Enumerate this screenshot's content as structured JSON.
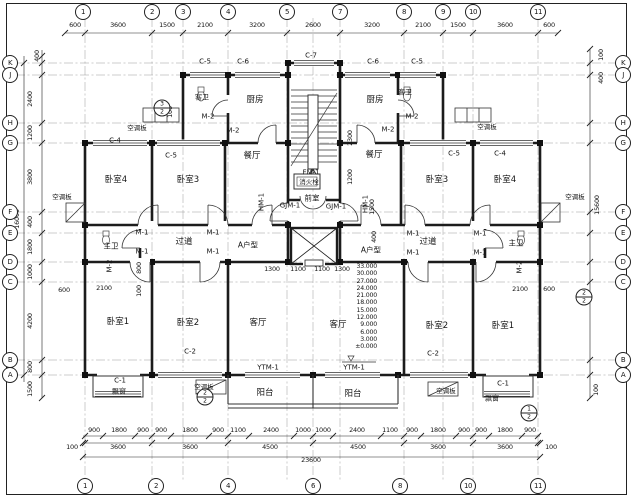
{
  "drawing": {
    "type": "architectural-floor-plan",
    "unit_type_label": "A户型",
    "background_color": "#ffffff",
    "line_color": "#1c1c1c",
    "grid_bubbles": [
      {
        "n": "1",
        "x": 83,
        "y": 12
      },
      {
        "n": "2",
        "x": 152,
        "y": 12
      },
      {
        "n": "3",
        "x": 183,
        "y": 12
      },
      {
        "n": "4",
        "x": 228,
        "y": 12
      },
      {
        "n": "5",
        "x": 287,
        "y": 12
      },
      {
        "n": "7",
        "x": 340,
        "y": 12
      },
      {
        "n": "8",
        "x": 404,
        "y": 12
      },
      {
        "n": "9",
        "x": 443,
        "y": 12
      },
      {
        "n": "10",
        "x": 473,
        "y": 12
      },
      {
        "n": "11",
        "x": 538,
        "y": 12
      },
      {
        "n": "1",
        "x": 85,
        "y": 486
      },
      {
        "n": "2",
        "x": 156,
        "y": 486
      },
      {
        "n": "4",
        "x": 228,
        "y": 486
      },
      {
        "n": "6",
        "x": 313,
        "y": 486
      },
      {
        "n": "8",
        "x": 400,
        "y": 486
      },
      {
        "n": "10",
        "x": 468,
        "y": 486
      },
      {
        "n": "11",
        "x": 538,
        "y": 486
      },
      {
        "n": "K",
        "x": 10,
        "y": 63
      },
      {
        "n": "J",
        "x": 10,
        "y": 75
      },
      {
        "n": "H",
        "x": 10,
        "y": 123
      },
      {
        "n": "G",
        "x": 10,
        "y": 143
      },
      {
        "n": "F",
        "x": 10,
        "y": 212
      },
      {
        "n": "E",
        "x": 10,
        "y": 233
      },
      {
        "n": "D",
        "x": 10,
        "y": 262
      },
      {
        "n": "C",
        "x": 10,
        "y": 282
      },
      {
        "n": "B",
        "x": 10,
        "y": 360
      },
      {
        "n": "A",
        "x": 10,
        "y": 375
      },
      {
        "n": "K",
        "x": 623,
        "y": 63
      },
      {
        "n": "J",
        "x": 623,
        "y": 75
      },
      {
        "n": "H",
        "x": 623,
        "y": 123
      },
      {
        "n": "G",
        "x": 623,
        "y": 143
      },
      {
        "n": "F",
        "x": 623,
        "y": 212
      },
      {
        "n": "E",
        "x": 623,
        "y": 233
      },
      {
        "n": "D",
        "x": 623,
        "y": 262
      },
      {
        "n": "C",
        "x": 623,
        "y": 282
      },
      {
        "n": "B",
        "x": 623,
        "y": 360
      },
      {
        "n": "A",
        "x": 623,
        "y": 375
      }
    ],
    "dim_labels": [
      {
        "t": "600",
        "x": 75,
        "y": 25
      },
      {
        "t": "3600",
        "x": 118,
        "y": 25
      },
      {
        "t": "1500",
        "x": 167,
        "y": 25
      },
      {
        "t": "2100",
        "x": 205,
        "y": 25
      },
      {
        "t": "3200",
        "x": 257,
        "y": 25
      },
      {
        "t": "2600",
        "x": 313,
        "y": 25
      },
      {
        "t": "3200",
        "x": 372,
        "y": 25
      },
      {
        "t": "2100",
        "x": 423,
        "y": 25
      },
      {
        "t": "1500",
        "x": 458,
        "y": 25
      },
      {
        "t": "3600",
        "x": 505,
        "y": 25
      },
      {
        "t": "600",
        "x": 549,
        "y": 25
      },
      {
        "t": "900",
        "x": 94,
        "y": 430
      },
      {
        "t": "1800",
        "x": 119,
        "y": 430
      },
      {
        "t": "900",
        "x": 143,
        "y": 430
      },
      {
        "t": "900",
        "x": 161,
        "y": 430
      },
      {
        "t": "1800",
        "x": 190,
        "y": 430
      },
      {
        "t": "900",
        "x": 218,
        "y": 430
      },
      {
        "t": "1100",
        "x": 238,
        "y": 430
      },
      {
        "t": "2400",
        "x": 271,
        "y": 430
      },
      {
        "t": "1000",
        "x": 303,
        "y": 430
      },
      {
        "t": "1000",
        "x": 323,
        "y": 430
      },
      {
        "t": "2400",
        "x": 357,
        "y": 430
      },
      {
        "t": "1100",
        "x": 390,
        "y": 430
      },
      {
        "t": "900",
        "x": 412,
        "y": 430
      },
      {
        "t": "1800",
        "x": 438,
        "y": 430
      },
      {
        "t": "900",
        "x": 464,
        "y": 430
      },
      {
        "t": "900",
        "x": 481,
        "y": 430
      },
      {
        "t": "1800",
        "x": 505,
        "y": 430
      },
      {
        "t": "900",
        "x": 530,
        "y": 430
      },
      {
        "t": "100",
        "x": 72,
        "y": 447
      },
      {
        "t": "3600",
        "x": 118,
        "y": 447
      },
      {
        "t": "3600",
        "x": 190,
        "y": 447
      },
      {
        "t": "4500",
        "x": 270,
        "y": 447
      },
      {
        "t": "4500",
        "x": 358,
        "y": 447
      },
      {
        "t": "3600",
        "x": 438,
        "y": 447
      },
      {
        "t": "3600",
        "x": 505,
        "y": 447
      },
      {
        "t": "100",
        "x": 551,
        "y": 447
      },
      {
        "t": "23600",
        "x": 311,
        "y": 460
      },
      {
        "t": "400",
        "x": 37,
        "y": 56,
        "r": -90
      },
      {
        "t": "2400",
        "x": 30,
        "y": 99,
        "r": -90
      },
      {
        "t": "1200",
        "x": 30,
        "y": 133,
        "r": -90
      },
      {
        "t": "3800",
        "x": 30,
        "y": 177,
        "r": -90
      },
      {
        "t": "400",
        "x": 30,
        "y": 222,
        "r": -90
      },
      {
        "t": "1800",
        "x": 30,
        "y": 247,
        "r": -90
      },
      {
        "t": "1000",
        "x": 30,
        "y": 272,
        "r": -90
      },
      {
        "t": "4200",
        "x": 30,
        "y": 321,
        "r": -90
      },
      {
        "t": "800",
        "x": 30,
        "y": 367,
        "r": -90
      },
      {
        "t": "1500",
        "x": 30,
        "y": 389,
        "r": -90
      },
      {
        "t": "16000",
        "x": 17,
        "y": 219,
        "r": -90
      },
      {
        "t": "100",
        "x": 601,
        "y": 55,
        "r": -90
      },
      {
        "t": "400",
        "x": 601,
        "y": 78,
        "r": -90
      },
      {
        "t": "15600",
        "x": 597,
        "y": 205,
        "r": -90
      },
      {
        "t": "100",
        "x": 596,
        "y": 390,
        "r": -90
      },
      {
        "t": "100",
        "x": 170,
        "y": 112,
        "r": -90
      },
      {
        "t": "2300",
        "x": 350,
        "y": 138,
        "r": -90
      },
      {
        "t": "1200",
        "x": 350,
        "y": 177,
        "r": -90
      },
      {
        "t": "1500",
        "x": 372,
        "y": 207,
        "r": -90
      },
      {
        "t": "400",
        "x": 374,
        "y": 237,
        "r": -90
      },
      {
        "t": "800",
        "x": 139,
        "y": 268,
        "r": -90
      },
      {
        "t": "100",
        "x": 139,
        "y": 291,
        "r": -90
      },
      {
        "t": "600",
        "x": 64,
        "y": 290
      },
      {
        "t": "2100",
        "x": 104,
        "y": 288
      },
      {
        "t": "2100",
        "x": 520,
        "y": 289
      },
      {
        "t": "600",
        "x": 549,
        "y": 289
      },
      {
        "t": "1300",
        "x": 272,
        "y": 269
      },
      {
        "t": "1100",
        "x": 298,
        "y": 269
      },
      {
        "t": "1100",
        "x": 322,
        "y": 269
      },
      {
        "t": "1300",
        "x": 342,
        "y": 269
      }
    ],
    "room_labels": [
      {
        "t": "厨房",
        "x": 255,
        "y": 100
      },
      {
        "t": "厨房",
        "x": 375,
        "y": 100
      },
      {
        "t": "客卫",
        "x": 202,
        "y": 98,
        "s": 7
      },
      {
        "t": "客卫",
        "x": 405,
        "y": 93,
        "s": 7
      },
      {
        "t": "餐厅",
        "x": 252,
        "y": 156
      },
      {
        "t": "餐厅",
        "x": 374,
        "y": 155
      },
      {
        "t": "卧室4",
        "x": 116,
        "y": 180
      },
      {
        "t": "卧室3",
        "x": 188,
        "y": 180
      },
      {
        "t": "卧室3",
        "x": 437,
        "y": 180
      },
      {
        "t": "卧室4",
        "x": 505,
        "y": 180
      },
      {
        "t": "过道",
        "x": 184,
        "y": 242
      },
      {
        "t": "过道",
        "x": 428,
        "y": 242
      },
      {
        "t": "A户型",
        "x": 248,
        "y": 245,
        "s": 7.5
      },
      {
        "t": "A户型",
        "x": 371,
        "y": 250,
        "s": 7.5
      },
      {
        "t": "主卫",
        "x": 111,
        "y": 246,
        "s": 7.5
      },
      {
        "t": "主卫",
        "x": 516,
        "y": 243,
        "s": 7.5
      },
      {
        "t": "前室",
        "x": 312,
        "y": 198,
        "s": 7.5
      },
      {
        "t": "消火栓",
        "x": 309,
        "y": 182,
        "s": 6.5
      },
      {
        "t": "卧室1",
        "x": 118,
        "y": 322
      },
      {
        "t": "卧室2",
        "x": 188,
        "y": 323
      },
      {
        "t": "客厅",
        "x": 258,
        "y": 323
      },
      {
        "t": "客厅",
        "x": 338,
        "y": 325
      },
      {
        "t": "卧室2",
        "x": 437,
        "y": 326
      },
      {
        "t": "卧室1",
        "x": 503,
        "y": 326
      },
      {
        "t": "阳台",
        "x": 265,
        "y": 393
      },
      {
        "t": "阳台",
        "x": 353,
        "y": 394
      },
      {
        "t": "飘窗",
        "x": 119,
        "y": 392,
        "s": 7
      },
      {
        "t": "飘窗",
        "x": 492,
        "y": 399,
        "s": 7
      },
      {
        "t": "空调板",
        "x": 137,
        "y": 128,
        "s": 6.5
      },
      {
        "t": "空调板",
        "x": 487,
        "y": 127,
        "s": 6.5
      },
      {
        "t": "空调板",
        "x": 62,
        "y": 197,
        "s": 6.5
      },
      {
        "t": "空调板",
        "x": 575,
        "y": 197,
        "s": 6.5
      },
      {
        "t": "空调板",
        "x": 204,
        "y": 387,
        "s": 6.5
      },
      {
        "t": "空调板",
        "x": 446,
        "y": 391,
        "s": 6.5
      }
    ],
    "component_labels": [
      {
        "t": "C-5",
        "x": 205,
        "y": 62
      },
      {
        "t": "C-6",
        "x": 243,
        "y": 62
      },
      {
        "t": "C-7",
        "x": 311,
        "y": 56
      },
      {
        "t": "C-6",
        "x": 373,
        "y": 62
      },
      {
        "t": "C-5",
        "x": 417,
        "y": 62
      },
      {
        "t": "C-4",
        "x": 115,
        "y": 141
      },
      {
        "t": "C-5",
        "x": 171,
        "y": 156
      },
      {
        "t": "C-5",
        "x": 454,
        "y": 154
      },
      {
        "t": "C-4",
        "x": 500,
        "y": 154
      },
      {
        "t": "M-2",
        "x": 208,
        "y": 117
      },
      {
        "t": "M-2",
        "x": 233,
        "y": 131
      },
      {
        "t": "M-2",
        "x": 412,
        "y": 117
      },
      {
        "t": "M-2",
        "x": 388,
        "y": 130
      },
      {
        "t": "M-1",
        "x": 142,
        "y": 233
      },
      {
        "t": "M-1",
        "x": 142,
        "y": 252
      },
      {
        "t": "M-1",
        "x": 213,
        "y": 233
      },
      {
        "t": "M-1",
        "x": 213,
        "y": 252
      },
      {
        "t": "M-1",
        "x": 413,
        "y": 234
      },
      {
        "t": "M-1",
        "x": 413,
        "y": 253
      },
      {
        "t": "M-1",
        "x": 480,
        "y": 234
      },
      {
        "t": "M-1",
        "x": 480,
        "y": 253
      },
      {
        "t": "M-2",
        "x": 110,
        "y": 266,
        "r": -90
      },
      {
        "t": "M-2",
        "x": 520,
        "y": 267,
        "r": -90
      },
      {
        "t": "FM-1",
        "x": 311,
        "y": 173
      },
      {
        "t": "GJM-1",
        "x": 290,
        "y": 206
      },
      {
        "t": "GJM-1",
        "x": 336,
        "y": 207
      },
      {
        "t": "HM-1",
        "x": 262,
        "y": 202,
        "r": -90
      },
      {
        "t": "HM-1",
        "x": 366,
        "y": 204,
        "r": -90
      },
      {
        "t": "YTM-1",
        "x": 268,
        "y": 368
      },
      {
        "t": "YTM-1",
        "x": 354,
        "y": 368
      },
      {
        "t": "C-2",
        "x": 190,
        "y": 352
      },
      {
        "t": "C-2",
        "x": 433,
        "y": 354
      },
      {
        "t": "C-1",
        "x": 120,
        "y": 381
      },
      {
        "t": "C-1",
        "x": 503,
        "y": 384
      }
    ],
    "floor_levels": {
      "right_edge_x": 377,
      "top_y": 263,
      "line_height": 7.3,
      "values": [
        "33.000",
        "30.000",
        "27.000",
        "24.000",
        "21.000",
        "18.000",
        "15.000",
        "12.000",
        "9.000",
        "6.000",
        "3.000",
        "±0.000"
      ]
    },
    "detail_callouts": [
      {
        "num": "3",
        "den": "2",
        "x": 162,
        "y": 108
      },
      {
        "num": "2",
        "den": "2",
        "x": 205,
        "y": 397
      },
      {
        "num": "2",
        "den": "2",
        "x": 584,
        "y": 297
      },
      {
        "num": "1",
        "den": "2",
        "x": 529,
        "y": 413
      }
    ]
  }
}
